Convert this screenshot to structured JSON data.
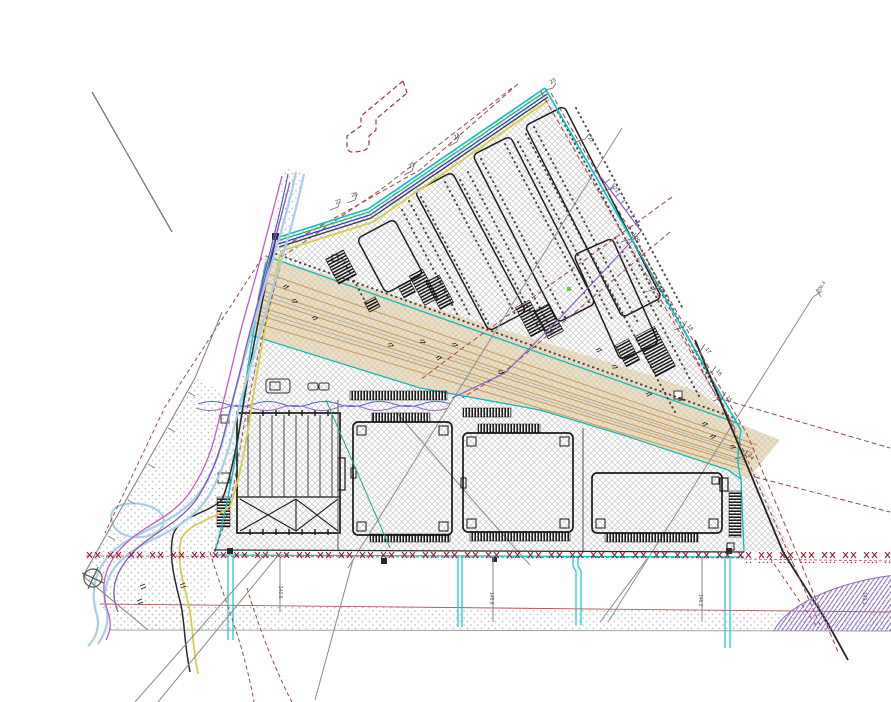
{
  "drawing": {
    "kind": "cadastral-site-plan",
    "description": "CAD master plan of a triangular industrial site with parking strips, four warehouse buildings, a diagonal road corridor, a stream on the west side and a road band at the bottom",
    "background": "#ffffff"
  },
  "colors": {
    "boundary_cyan": "#00c6d2",
    "boundary_green": "#2fae62",
    "boundary_blue": "#2d35c8",
    "boundary_yellow": "#d6ce4a",
    "boundary_black": "#2a2a2a",
    "parcel_hatch": "#c9c9c9",
    "corridor_fill": "#eadfc8",
    "corridor_stripe": "#cc9a55",
    "fence_red": "#942339",
    "road_red": "#a04545",
    "stream_blue": "#a8cde4",
    "stream_magenta": "#c45ac8",
    "stream_purple": "#7e57c0",
    "utility_purple": "#7a5ec8",
    "survey_gray": "#888888",
    "building_line": "#1a1a1a",
    "green_marker": "#66cc33",
    "ellipse_purple": "#8868c8"
  },
  "labels": [
    {
      "text": "27"
    },
    {
      "text": "26"
    },
    {
      "text": "25"
    },
    {
      "text": "24"
    },
    {
      "text": "23"
    },
    {
      "text": "22"
    },
    {
      "text": "21"
    },
    {
      "text": "20"
    },
    {
      "text": "19"
    },
    {
      "text": "18"
    },
    {
      "text": "17"
    },
    {
      "text": "16"
    },
    {
      "text": "15"
    },
    {
      "text": "14"
    },
    {
      "text": "140.6"
    },
    {
      "text": "145.8"
    },
    {
      "text": "146.2"
    },
    {
      "text": "143.1"
    },
    {
      "text": "206.4"
    }
  ]
}
